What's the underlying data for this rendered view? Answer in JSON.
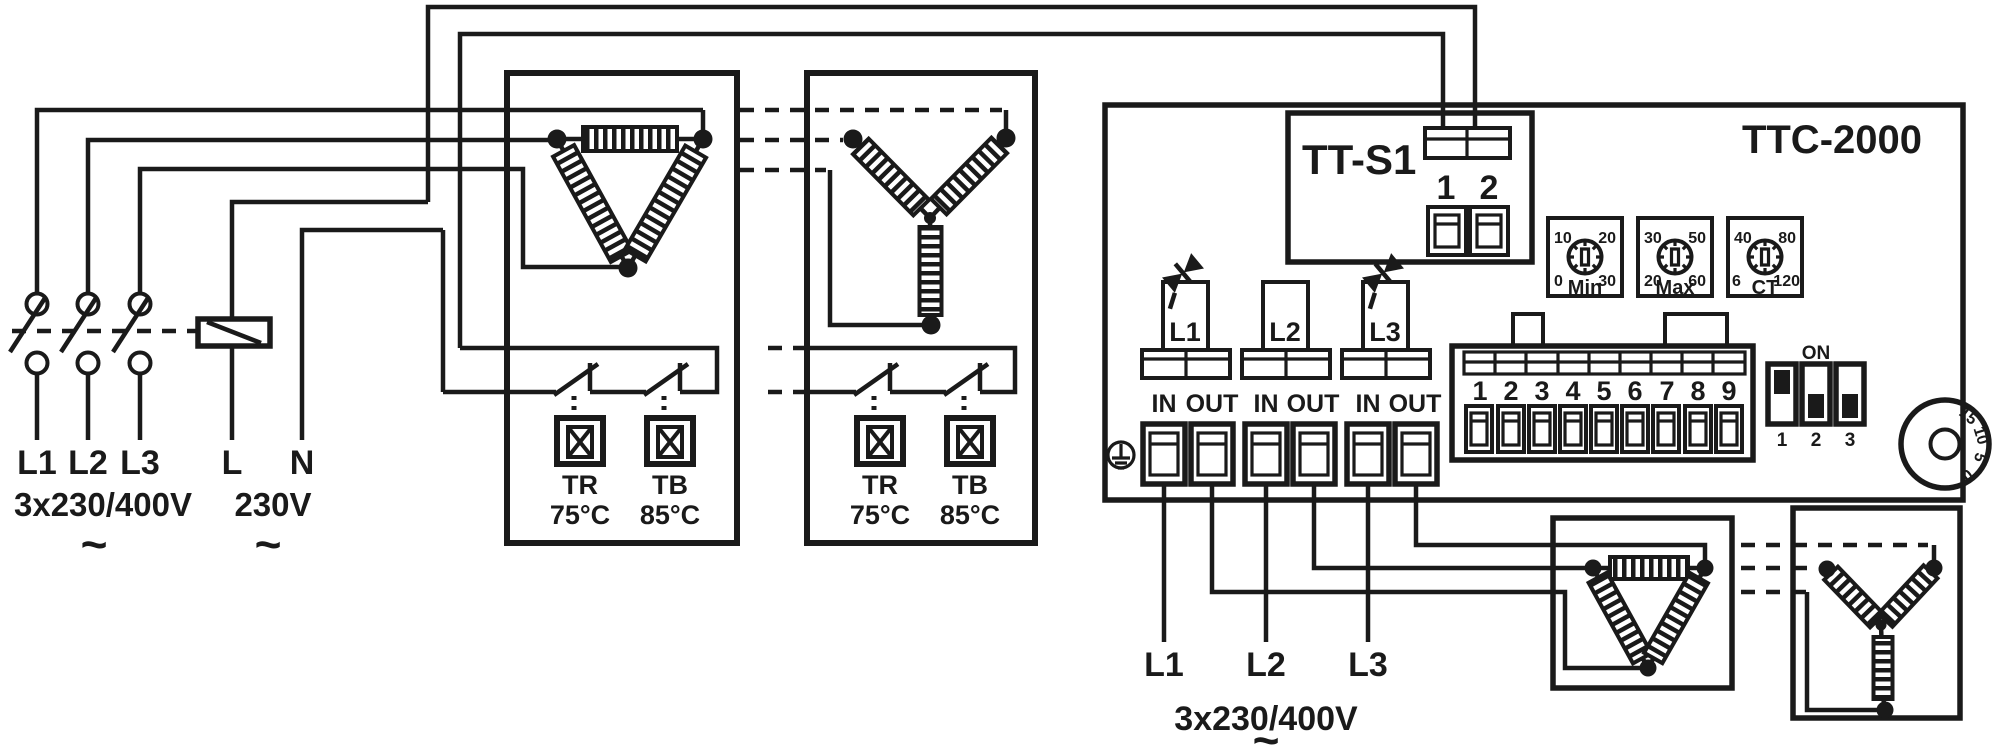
{
  "colors": {
    "ink": "#1a1a1a",
    "bg": "#ffffff"
  },
  "supply": {
    "l1": "L1",
    "l2": "L2",
    "l3": "L3",
    "three_phase": "3x230/400V",
    "ac": "~",
    "l": "L",
    "n": "N",
    "single_phase": "230V"
  },
  "delta_box": {
    "tr": "TR",
    "tr_temp": "75°C",
    "tb": "TB",
    "tb_temp": "85°C"
  },
  "star_box": {
    "tr": "TR",
    "tr_temp": "75°C",
    "tb": "TB",
    "tb_temp": "85°C"
  },
  "tts1": {
    "title": "TT-S1",
    "term1": "1",
    "term2": "2"
  },
  "ttc": {
    "title": "TTC-2000",
    "phase1": "L1",
    "phase2": "L2",
    "phase3": "L3",
    "in": "IN",
    "out": "OUT",
    "dial_min": {
      "name": "Min",
      "tl": "10",
      "tr": "20",
      "bl": "0",
      "br": "30"
    },
    "dial_max": {
      "name": "Max",
      "tl": "30",
      "tr": "50",
      "bl": "20",
      "br": "60"
    },
    "dial_ct": {
      "name": "CT",
      "tl": "40",
      "tr": "80",
      "bl": "6",
      "br": "120"
    },
    "terminals": [
      "1",
      "2",
      "3",
      "4",
      "5",
      "6",
      "7",
      "8",
      "9"
    ],
    "dip": {
      "on": "ON",
      "s1": "1",
      "s2": "2",
      "s3": "3"
    },
    "knob": [
      "15",
      "10",
      "5",
      "0"
    ]
  },
  "load": {
    "l1": "L1",
    "l2": "L2",
    "l3": "L3",
    "voltage": "3x230/400V",
    "ac": "~"
  }
}
